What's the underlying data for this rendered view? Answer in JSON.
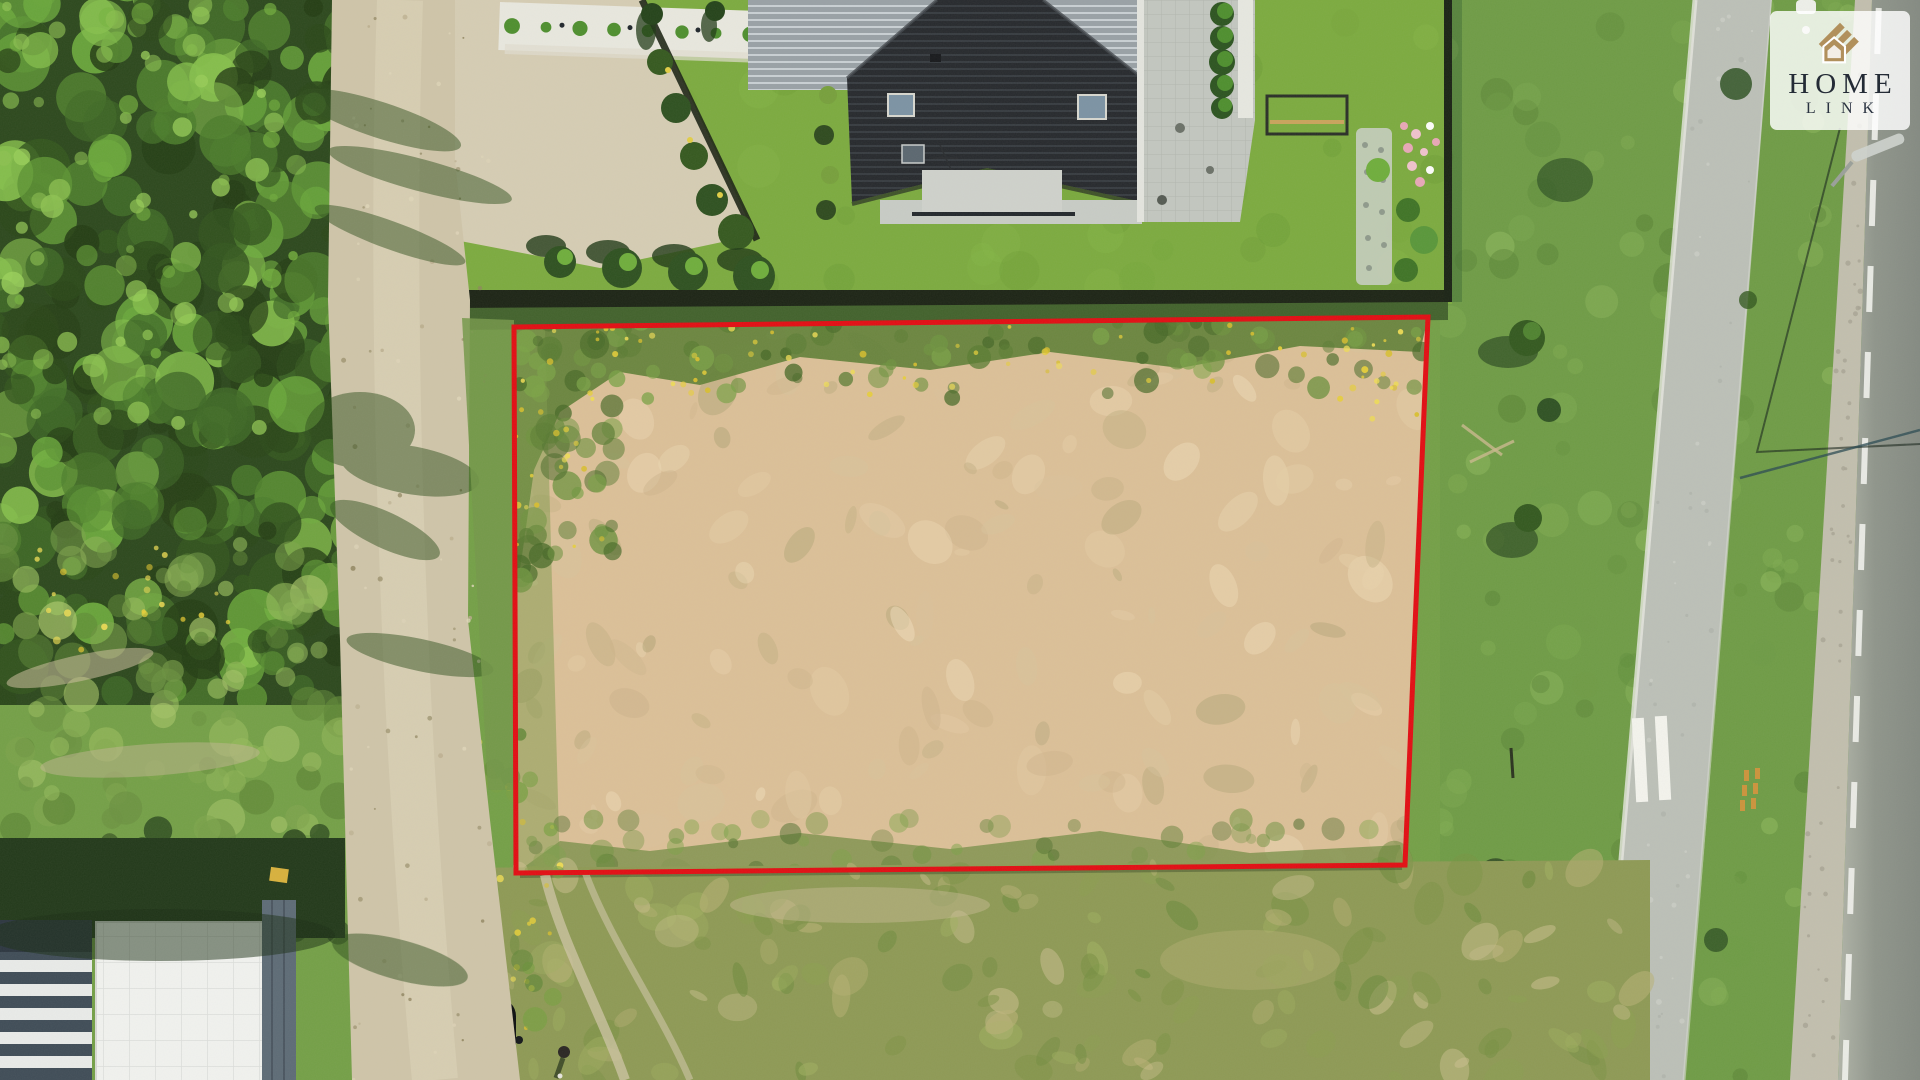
{
  "watermark": {
    "brand_line1": "HOME",
    "brand_line2": "LINK"
  },
  "colors": {
    "boundary_red": "#e30d13",
    "logo_gold": "#b1905c",
    "logo_text": "#242b36",
    "logo_bg": "rgba(255,255,255,0.82)"
  }
}
